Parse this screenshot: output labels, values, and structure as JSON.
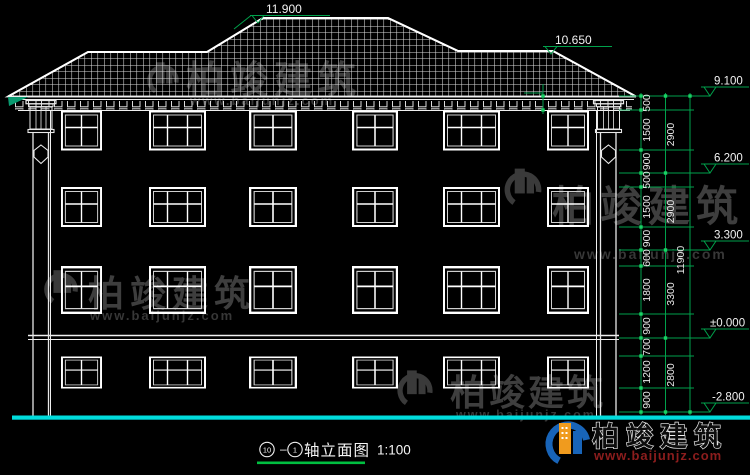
{
  "colors": {
    "dim_green": "#00a14b",
    "tick_green": "#19d264",
    "ground_cyan": "#00dcdc",
    "underline_green": "#00bf40",
    "gutter_teal": "#0a9a70",
    "logo_blue": "#1864b8",
    "logo_orange": "#f09b1e",
    "url_red": "#8c1d1d",
    "line_white": "#ffffff",
    "watermark_gray": "#454545"
  },
  "elevations": {
    "ridge": "11.900",
    "wing_ridge": "10.650",
    "eave": "9.100",
    "floor3": "6.200",
    "floor2": "3.300",
    "ground": "±0.000",
    "basement": "-2.800"
  },
  "dimensions": {
    "col1": [
      "500",
      "1500",
      "900",
      "500",
      "1500",
      "900",
      "600",
      "1800",
      "900",
      "700",
      "1200",
      "900"
    ],
    "col2": [
      "2900",
      "2900",
      "3300",
      "2800"
    ],
    "total": "11900"
  },
  "title": {
    "axis_start": "10",
    "separator": "–",
    "axis_end": "1",
    "name": "轴立面图",
    "scale": "1:100"
  },
  "watermark": {
    "brand": "柏竣建筑",
    "url": "www.baijunjz.com"
  },
  "brand": {
    "name": "柏竣建筑",
    "url": "www.baijunjz.com"
  }
}
